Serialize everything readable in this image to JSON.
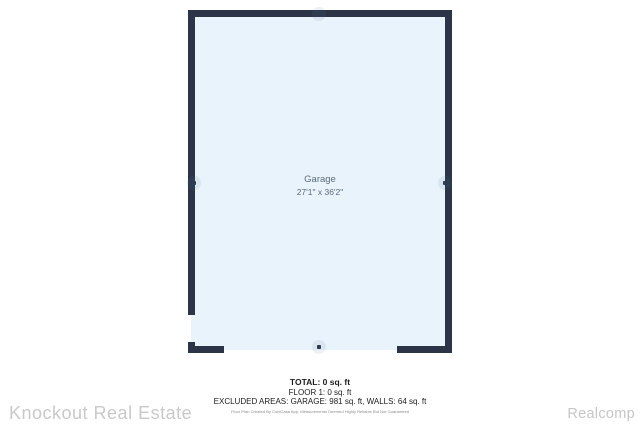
{
  "floor_plan": {
    "room_label": "Garage",
    "room_dimensions": "27'1\" x 36'2\"",
    "wall_color": "#2b3547",
    "floor_fill_color": "#e8f3fb",
    "label_color": "#5c6b7c"
  },
  "summary": {
    "lines": [
      "TOTAL: 0 sq. ft",
      "FLOOR 1: 0 sq. ft",
      "EXCLUDED AREAS: GARAGE: 981 sq. ft, WALLS: 64 sq. ft"
    ],
    "disclaimer": "Floor Plan Created By CubiCasa App. Measurements Deemed Highly Reliable But Not Guaranteed"
  },
  "watermarks": {
    "left": "Knockout Real Estate",
    "right": "Realcomp"
  }
}
